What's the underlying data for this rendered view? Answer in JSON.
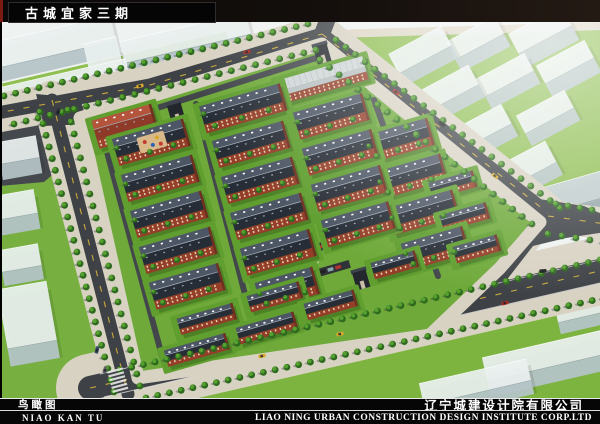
{
  "header": {
    "title": "古城宜家三期"
  },
  "footer": {
    "label_cn": "鸟瞰图",
    "label_pinyin": "NIAO KAN TU",
    "company_cn": "辽宁城建设计院有限公司",
    "company_en": "LIAO NING URBAN CONSTRUCTION DESIGN INSTITUTE CORP.LTD"
  },
  "palette": {
    "canvas": "#eef2f0",
    "asphalt": "#3e4246",
    "sidewalk": "#d8d2c3",
    "dash": "#c9a83c",
    "site_green": "#6fa93a",
    "lawn_bright": "#86bb49",
    "lawn_deep": "#77b040",
    "roof_light": "#4d5665",
    "roof_dark": "#272d36",
    "ridge": "#a8b4bf",
    "brick": "#943e29",
    "brick_dark": "#6e301f",
    "window": "#e8d4b2",
    "tree_dark": "#2d6a1e",
    "tree_light": "#55a02e",
    "tree_shadow": "#3c4046",
    "mass_top": "#e9f0ef",
    "mass_side": "#b6c6ca",
    "plaza": "#ddd5c2"
  },
  "scene": {
    "lawns": [
      {
        "pts": [
          [
            332,
            30
          ],
          [
            600,
            24
          ],
          [
            600,
            210
          ],
          [
            556,
            216
          ]
        ],
        "fill": "#8cbd4e"
      },
      {
        "pts": [
          [
            0,
            104
          ],
          [
            46,
            96
          ],
          [
            124,
            392
          ],
          [
            60,
            398
          ],
          [
            0,
            398
          ]
        ],
        "fill": "#77b040"
      },
      {
        "pts": [
          [
            90,
            398
          ],
          [
            604,
            282
          ],
          [
            604,
            398
          ]
        ],
        "fill": "#7db43f"
      },
      {
        "pts": [
          [
            330,
            30
          ],
          [
            604,
            22
          ],
          [
            604,
            30
          ],
          [
            336,
            38
          ]
        ],
        "fill": "#ddd6c5"
      },
      {
        "pts": [
          [
            0,
            104
          ],
          [
            56,
            92
          ],
          [
            82,
            150
          ],
          [
            44,
            182
          ],
          [
            0,
            186
          ]
        ],
        "fill": "#45494e"
      }
    ],
    "green_strips": [
      {
        "x": 115,
        "y": 62,
        "l": 230,
        "d": 9,
        "a": -13,
        "fill": "#8fbf51"
      },
      {
        "x": 125,
        "y": 95,
        "l": 260,
        "d": 10,
        "a": -13,
        "fill": "#8fbf51"
      }
    ],
    "blocks": [
      {
        "x": 40,
        "y": 45,
        "l": 150,
        "d": 26,
        "a": -13,
        "h": 14
      },
      {
        "x": 185,
        "y": 38,
        "l": 130,
        "d": 22,
        "a": -13,
        "h": 12
      },
      {
        "x": 60,
        "y": 85,
        "l": 140,
        "d": 22,
        "a": -13,
        "h": 12
      },
      {
        "x": 205,
        "y": 70,
        "l": 120,
        "d": 20,
        "a": -13,
        "h": 12
      },
      {
        "x": 103,
        "y": 55,
        "l": 34,
        "d": 30,
        "a": -13,
        "h": 34
      },
      {
        "x": 18,
        "y": 150,
        "l": 40,
        "d": 22,
        "a": -10,
        "h": 16
      },
      {
        "x": 14,
        "y": 205,
        "l": 44,
        "d": 24,
        "a": -10,
        "h": 16
      },
      {
        "x": 20,
        "y": 258,
        "l": 40,
        "d": 22,
        "a": -10,
        "h": 14
      },
      {
        "x": 420,
        "y": 50,
        "l": 60,
        "d": 22,
        "a": -28,
        "h": 14
      },
      {
        "x": 475,
        "y": 38,
        "l": 55,
        "d": 20,
        "a": -28,
        "h": 14
      },
      {
        "x": 540,
        "y": 30,
        "l": 60,
        "d": 22,
        "a": -28,
        "h": 16
      },
      {
        "x": 445,
        "y": 90,
        "l": 65,
        "d": 22,
        "a": -28,
        "h": 14
      },
      {
        "x": 505,
        "y": 75,
        "l": 55,
        "d": 20,
        "a": -28,
        "h": 14
      },
      {
        "x": 565,
        "y": 62,
        "l": 55,
        "d": 20,
        "a": -28,
        "h": 16
      },
      {
        "x": 480,
        "y": 128,
        "l": 60,
        "d": 22,
        "a": -28,
        "h": 14
      },
      {
        "x": 545,
        "y": 112,
        "l": 55,
        "d": 20,
        "a": -28,
        "h": 14
      },
      {
        "x": 520,
        "y": 168,
        "l": 70,
        "d": 24,
        "a": -28,
        "h": 14
      },
      {
        "x": 575,
        "y": 192,
        "l": 60,
        "d": 26,
        "a": -16,
        "h": 16,
        "top": "#c3ced6",
        "side": "#97a6b2"
      },
      {
        "x": 548,
        "y": 355,
        "l": 130,
        "d": 24,
        "a": -13,
        "h": 16
      },
      {
        "x": 475,
        "y": 382,
        "l": 110,
        "d": 22,
        "a": -13,
        "h": 14
      },
      {
        "x": 590,
        "y": 305,
        "l": 70,
        "d": 20,
        "a": -13,
        "h": 12
      },
      {
        "x": 27,
        "y": 315,
        "l": 50,
        "d": 60,
        "a": -10,
        "h": 18
      }
    ],
    "roads": [
      {
        "pts": [
          [
            -8,
            114
          ],
          [
            150,
            85
          ],
          [
            322,
            34
          ]
        ],
        "w": 13,
        "sw": 26,
        "dash": true
      },
      {
        "pts": [
          [
            322,
            34
          ],
          [
            332,
            8
          ]
        ],
        "w": 16,
        "sw": 0,
        "dash": false
      },
      {
        "pts": [
          [
            322,
            34
          ],
          [
            548,
            213
          ]
        ],
        "w": 13,
        "sw": 24,
        "dash": true
      },
      {
        "pts": [
          [
            548,
            216
          ],
          [
            606,
            224
          ]
        ],
        "w": 12,
        "sw": 20,
        "dash": true
      },
      {
        "pts": [
          [
            548,
            216
          ],
          [
            500,
            278
          ]
        ],
        "w": 13,
        "sw": 10,
        "dash": false
      },
      {
        "pts": [
          [
            90,
            388
          ],
          [
            604,
            270
          ]
        ],
        "w": 24,
        "sw": 44,
        "dash": true
      },
      {
        "pts": [
          [
            52,
            100
          ],
          [
            128,
            394
          ]
        ],
        "w": 13,
        "sw": 26,
        "dash": true
      },
      {
        "pts": [
          [
            362,
            282
          ],
          [
            377,
            318
          ]
        ],
        "w": 8,
        "sw": 6,
        "dash": false
      }
    ],
    "road_polys": [
      {
        "pts": [
          [
            520,
            196
          ],
          [
            584,
            206
          ],
          [
            606,
            216
          ],
          [
            606,
            232
          ],
          [
            566,
            238
          ],
          [
            508,
            252
          ]
        ]
      },
      {
        "pts": [
          [
            36,
            94
          ],
          [
            80,
            98
          ],
          [
            88,
            124
          ],
          [
            44,
            126
          ]
        ]
      }
    ],
    "edge_lines": [
      {
        "pts": [
          [
            100,
            374
          ],
          [
            604,
            259
          ]
        ]
      },
      {
        "pts": [
          [
            104,
            397
          ],
          [
            604,
            282
          ]
        ]
      }
    ],
    "site": {
      "pts": [
        [
          80,
          118
        ],
        [
          322,
          44
        ],
        [
          540,
          222
        ],
        [
          500,
          268
        ],
        [
          430,
          335
        ],
        [
          138,
          378
        ]
      ]
    },
    "inner_roads": [
      {
        "pts": [
          [
            100,
            126
          ],
          [
            316,
            58
          ]
        ]
      },
      {
        "pts": [
          [
            100,
            126
          ],
          [
            162,
            356
          ]
        ]
      },
      {
        "pts": [
          [
            196,
            104
          ],
          [
            248,
            306
          ]
        ]
      },
      {
        "pts": [
          [
            374,
            100
          ],
          [
            438,
            276
          ]
        ]
      }
    ],
    "plaza": {
      "axis": [
        [
          266,
          98
        ],
        [
          312,
          258
        ]
      ],
      "squares": [
        {
          "x": 268,
          "y": 140,
          "l": 32,
          "d": 40,
          "a": -16
        },
        {
          "x": 298,
          "y": 212,
          "l": 20,
          "d": 24,
          "a": -16
        }
      ],
      "planters": 10
    },
    "parking": [
      {
        "x": 282,
        "y": 233,
        "l": 48
      },
      {
        "x": 302,
        "y": 252,
        "l": 72
      },
      {
        "x": 318,
        "y": 273,
        "l": 66
      }
    ],
    "buildings": [
      {
        "t": "red",
        "x": 124,
        "y": 122,
        "l": 62
      },
      {
        "t": "white",
        "x": 322,
        "y": 76,
        "l": 88
      },
      {
        "t": "apt",
        "x": 150,
        "y": 138,
        "l": 74
      },
      {
        "t": "apt",
        "x": 159,
        "y": 174,
        "l": 74
      },
      {
        "t": "apt",
        "x": 168,
        "y": 210,
        "l": 74
      },
      {
        "t": "apt",
        "x": 177,
        "y": 246,
        "l": 74
      },
      {
        "t": "apt",
        "x": 186,
        "y": 282,
        "l": 72
      },
      {
        "t": "apt",
        "x": 242,
        "y": 104,
        "l": 84
      },
      {
        "t": "apt",
        "x": 250,
        "y": 140,
        "l": 74
      },
      {
        "t": "apt",
        "x": 259,
        "y": 176,
        "l": 74
      },
      {
        "t": "apt",
        "x": 268,
        "y": 212,
        "l": 74
      },
      {
        "t": "apt",
        "x": 277,
        "y": 248,
        "l": 72
      },
      {
        "t": "apt",
        "x": 286,
        "y": 284,
        "l": 60
      },
      {
        "t": "apt",
        "x": 330,
        "y": 112,
        "l": 72
      },
      {
        "t": "apt",
        "x": 339,
        "y": 148,
        "l": 72
      },
      {
        "t": "apt",
        "x": 348,
        "y": 184,
        "l": 72
      },
      {
        "t": "apt",
        "x": 357,
        "y": 220,
        "l": 70
      },
      {
        "t": "apt",
        "x": 398,
        "y": 136,
        "l": 66
      },
      {
        "t": "apt",
        "x": 410,
        "y": 172,
        "l": 68
      },
      {
        "t": "apt",
        "x": 422,
        "y": 208,
        "l": 68
      },
      {
        "t": "apt",
        "x": 434,
        "y": 244,
        "l": 64
      },
      {
        "t": "th",
        "x": 452,
        "y": 182,
        "l": 46
      },
      {
        "t": "th",
        "x": 464,
        "y": 214,
        "l": 48
      },
      {
        "t": "th",
        "x": 476,
        "y": 246,
        "l": 46
      },
      {
        "t": "th",
        "x": 196,
        "y": 347,
        "l": 64
      },
      {
        "t": "th",
        "x": 266,
        "y": 325,
        "l": 60
      },
      {
        "t": "th",
        "x": 330,
        "y": 302,
        "l": 52
      },
      {
        "t": "th",
        "x": 394,
        "y": 262,
        "l": 46
      },
      {
        "t": "th",
        "x": 206,
        "y": 316,
        "l": 58
      },
      {
        "t": "th",
        "x": 274,
        "y": 294,
        "l": 54
      },
      {
        "t": "gate",
        "x": 361,
        "y": 279
      },
      {
        "t": "gate",
        "x": 322,
        "y": 53
      },
      {
        "t": "gate",
        "x": 176,
        "y": 112
      }
    ],
    "tree_lines": [
      {
        "pts": [
          [
            4,
            96
          ],
          [
            308,
            24
          ]
        ]
      },
      {
        "pts": [
          [
            14,
            124
          ],
          [
            316,
            50
          ]
        ]
      },
      {
        "pts": [
          [
            336,
            40
          ],
          [
            560,
            208
          ]
        ]
      },
      {
        "pts": [
          [
            320,
            60
          ],
          [
            532,
            224
          ]
        ]
      },
      {
        "pts": [
          [
            40,
            112
          ],
          [
            114,
            392
          ]
        ]
      },
      {
        "pts": [
          [
            68,
            110
          ],
          [
            140,
            386
          ]
        ]
      },
      {
        "pts": [
          [
            120,
            370
          ],
          [
            600,
            260
          ]
        ]
      },
      {
        "pts": [
          [
            146,
            398
          ],
          [
            604,
            298
          ]
        ]
      },
      {
        "pts": [
          [
            556,
            204
          ],
          [
            604,
            212
          ]
        ]
      },
      {
        "pts": [
          [
            548,
            234
          ],
          [
            604,
            242
          ]
        ]
      }
    ],
    "cars": [
      {
        "x": 247,
        "y": 52,
        "a": -14,
        "c": "#a62c22"
      },
      {
        "x": 140,
        "y": 86,
        "a": -14,
        "c": "#d8a92e"
      },
      {
        "x": 58,
        "y": 112,
        "a": -70,
        "c": "#2a3038"
      },
      {
        "x": 97,
        "y": 350,
        "a": -76,
        "c": "#3a4a66"
      },
      {
        "x": 105,
        "y": 370,
        "a": -76,
        "c": "#666666"
      },
      {
        "x": 396,
        "y": 92,
        "a": 39,
        "c": "#a62c22"
      },
      {
        "x": 442,
        "y": 124,
        "a": 39,
        "c": "#222222"
      },
      {
        "x": 495,
        "y": 176,
        "a": 39,
        "c": "#d8a92e"
      },
      {
        "x": 340,
        "y": 334,
        "a": -13,
        "c": "#d8a92e"
      },
      {
        "x": 262,
        "y": 356,
        "a": -13,
        "c": "#d8a92e"
      },
      {
        "x": 505,
        "y": 303,
        "a": -13,
        "c": "#a62c22"
      },
      {
        "x": 543,
        "y": 271,
        "a": -4,
        "c": "#222222"
      }
    ],
    "crosswalk": {
      "x": 118,
      "y": 381,
      "a": 75,
      "n": 6
    }
  }
}
